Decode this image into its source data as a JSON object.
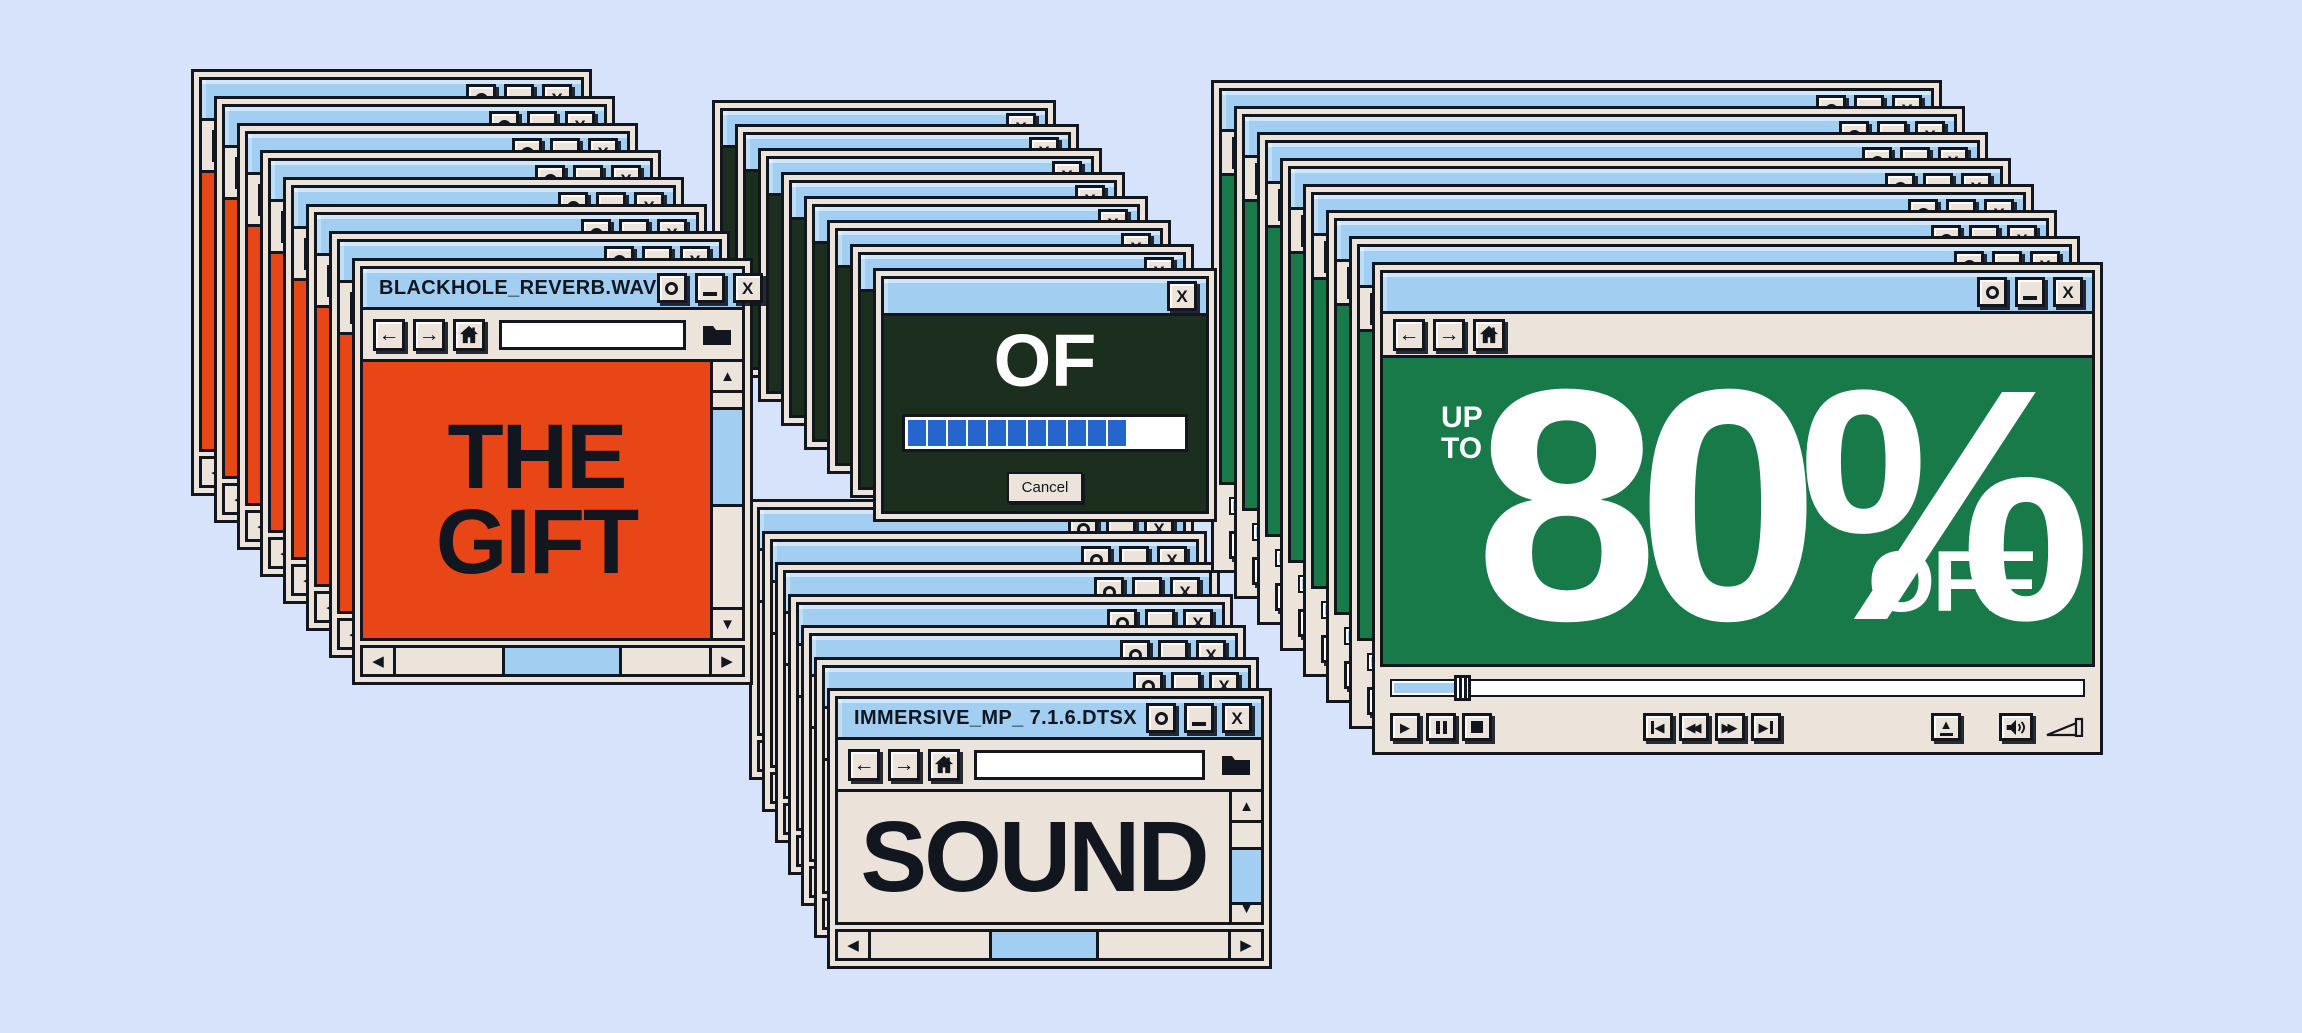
{
  "page": {
    "background_color": "#D7E3FB"
  },
  "palette": {
    "titlebar_blue": "#A2CEF2",
    "chrome_beige": "#ECE4DA",
    "ink": "#11161F",
    "orange": "#E94617",
    "dark_green": "#1C2F1E",
    "green": "#187A48",
    "progress_blue": "#2565CD",
    "white": "#FFFFFF"
  },
  "windows": {
    "gift": {
      "title": "BLACKHOLE_REVERB.WAV",
      "line1": "THE",
      "line2": "GIFT",
      "address_value": ""
    },
    "of_dialog": {
      "title": "",
      "word": "OF",
      "cancel_label": "Cancel",
      "progress": {
        "segments_filled": 11,
        "percent_filled": 79
      }
    },
    "deal": {
      "title": "",
      "up": "UP",
      "to": "TO",
      "percent": "80%",
      "off": "OFF",
      "seek_percent": 9
    },
    "sound": {
      "title": "IMMERSIVE_MP_ 7.1.6.DTSX",
      "word": "SOUND",
      "address_value": ""
    }
  },
  "window_button_glyphs": {
    "maximize": "O",
    "minimize": "_",
    "close": "X"
  },
  "toolbar_glyphs": {
    "back": "←",
    "forward": "→"
  },
  "scroll_glyphs": {
    "up": "▲",
    "down": "▼",
    "left": "◀",
    "right": "▶"
  },
  "media_glyphs": {
    "play": "▶",
    "rewind": "◀◀",
    "fast_forward": "▶▶",
    "skip_start": "◀",
    "skip_end": "▶",
    "eject": "▲"
  },
  "stacks": [
    {
      "name": "sound-stack",
      "type": "browser",
      "content_color": "#EBE3D9",
      "x": 827,
      "y": 688,
      "w": 445,
      "h": 281,
      "count": 7,
      "dx": 13,
      "dy": 31.5,
      "z": 10
    },
    {
      "name": "deal-stack",
      "type": "player",
      "content_color": "#187A48",
      "x": 1372,
      "y": 262,
      "w": 731,
      "h": 493,
      "count": 8,
      "dx": 23,
      "dy": 26,
      "z": 20
    },
    {
      "name": "of-stack",
      "type": "dialog",
      "content_color": "#1C2F1E",
      "x": 873,
      "y": 268,
      "w": 344,
      "h": 254,
      "count": 8,
      "dx": 23,
      "dy": 24,
      "z": 30
    },
    {
      "name": "gift-stack",
      "type": "browser",
      "content_color": "#E94617",
      "x": 352,
      "y": 258,
      "w": 401,
      "h": 427,
      "count": 8,
      "dx": 23,
      "dy": 27,
      "z": 40
    }
  ]
}
